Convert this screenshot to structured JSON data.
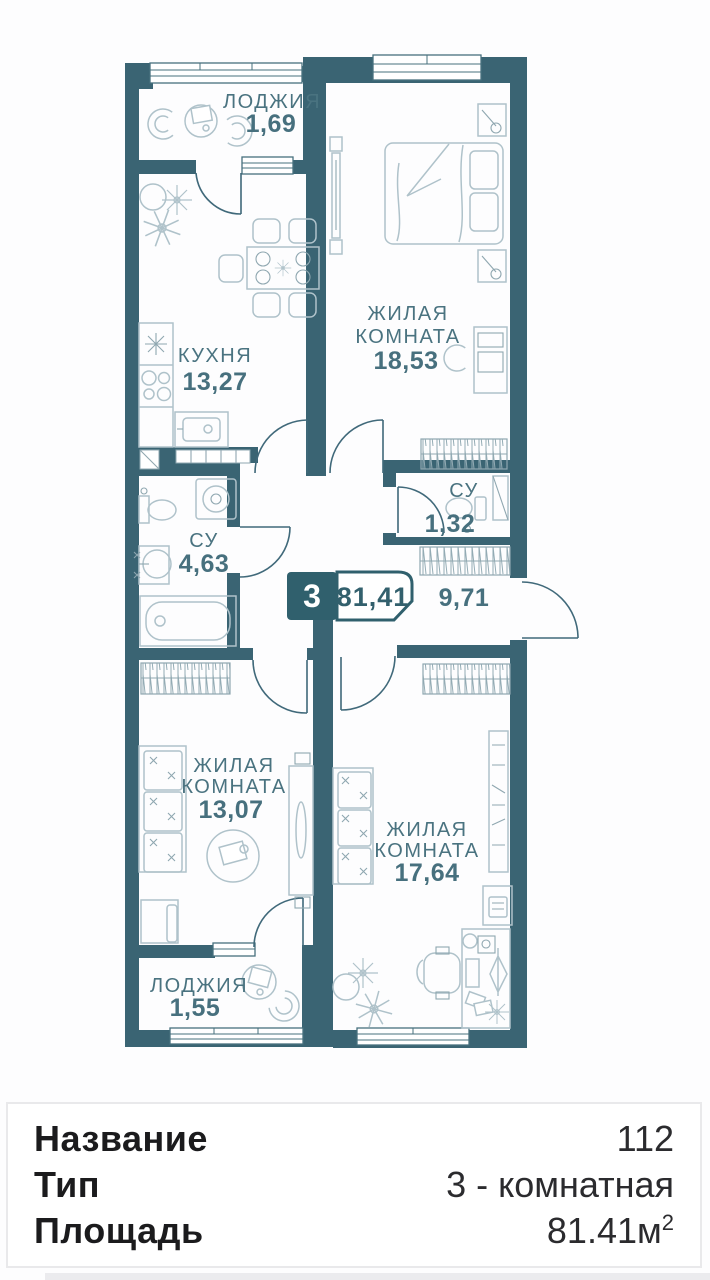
{
  "plan": {
    "badge": {
      "room_count": "3",
      "total_area": "81,41"
    },
    "labels": {
      "loggia_top": {
        "name": "ЛОДЖИЯ",
        "area": "1,69"
      },
      "bedroom": {
        "name1": "ЖИЛАЯ",
        "name2": "КОМНАТА",
        "area": "18,53"
      },
      "kitchen": {
        "name": "КУХНЯ",
        "area": "13,27"
      },
      "bathroom": {
        "name": "СУ",
        "area": "4,63"
      },
      "wc": {
        "name": "СУ",
        "area": "1,32"
      },
      "hallway": {
        "area": "9,71"
      },
      "room_left": {
        "name1": "ЖИЛАЯ",
        "name2": "КОМНАТА",
        "area": "13,07"
      },
      "room_right": {
        "name1": "ЖИЛАЯ",
        "name2": "КОМНАТА",
        "area": "17,64"
      },
      "loggia_bottom": {
        "name": "ЛОДЖИЯ",
        "area": "1,55"
      }
    }
  },
  "info_card": {
    "rows": [
      {
        "label": "Название",
        "value": "112"
      },
      {
        "label": "Тип",
        "value": "3 - комнатная"
      },
      {
        "label": "Площадь",
        "value": "81.41м",
        "sup": "2"
      }
    ]
  },
  "colors": {
    "wall": "#3a6473",
    "plan_text": "#47707e",
    "badge_bg": "#30606d"
  }
}
